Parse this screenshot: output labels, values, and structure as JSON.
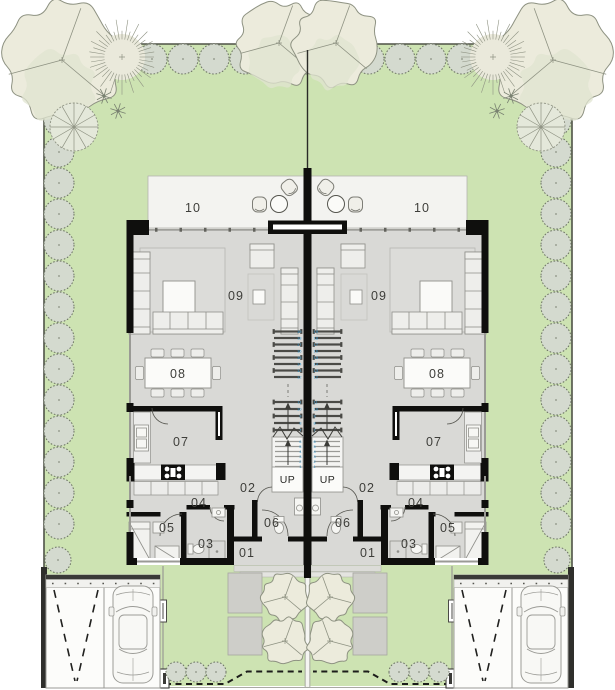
{
  "rooms": {
    "terrace": "10",
    "living": "09",
    "dining": "08",
    "kitchen": "07",
    "hallway": "02",
    "corridor": "04",
    "bedroom": "05",
    "bathroom": "03",
    "wc": "06",
    "entrance": "01"
  },
  "stairs": {
    "up": "UP",
    "flight1": [
      "1",
      "2",
      "3",
      "4",
      "5",
      "6"
    ],
    "flight2": [
      "7",
      "8",
      "9",
      "10",
      "11"
    ],
    "flight3": [
      "12",
      "13",
      "14",
      "15",
      "16",
      "17",
      "18",
      "19"
    ]
  },
  "colors": {
    "lawn": "#cde3b2",
    "hedge_fill": "#d4dacf",
    "hedge_stroke": "#6b7263",
    "tree_fill": "#ecebdc",
    "tree_stroke": "#8e9282",
    "tree_shade": "#e0e4d0",
    "floor": "#d9d9d6",
    "terrace": "#f3f3f0",
    "wall": "#0f0f0d",
    "furniture_stroke": "#8f8f8a",
    "furniture_fill": "#eeeeeb",
    "stair_tread": "#4a4a46",
    "step_number_blue": "#2f97cf",
    "paver": "#cecec9",
    "label": "#3e3e3a",
    "boundary": "#4e5246",
    "glass": "#9a9a95",
    "car_stroke": "#9b9b96"
  }
}
